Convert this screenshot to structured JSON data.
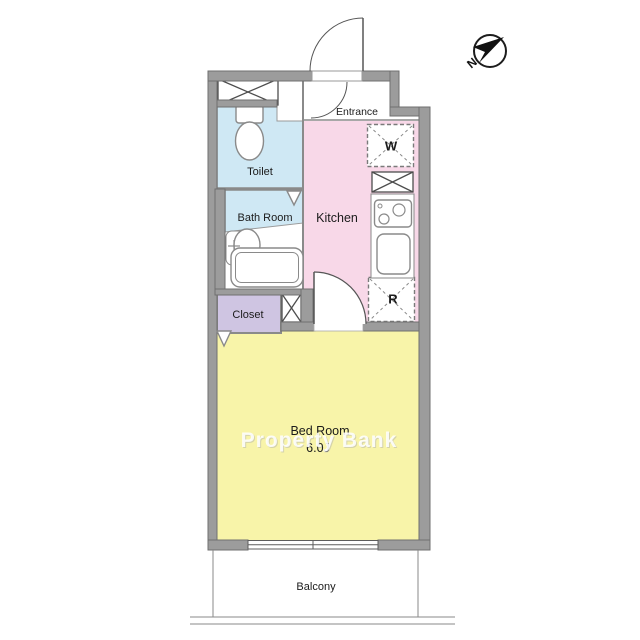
{
  "floor_plan": {
    "watermark": "Property Bank",
    "compass": {
      "north": "N"
    },
    "rooms": {
      "entrance": "Entrance",
      "toilet": "Toilet",
      "bath_room": "Bath Room",
      "kitchen": "Kitchen",
      "closet": "Closet",
      "bed_room": "Bed Room",
      "bed_room_size": "6.0J",
      "balcony": "Balcony"
    },
    "appliances": {
      "washer": "W",
      "refrigerator": "R"
    },
    "colors": {
      "wall": "#9c9c9c",
      "wet_rooms": "#cfe8f4",
      "kitchen_floor": "#f8d8e8",
      "closet_floor": "#cfc5e2",
      "bedroom_floor": "#f8f4a9"
    }
  }
}
